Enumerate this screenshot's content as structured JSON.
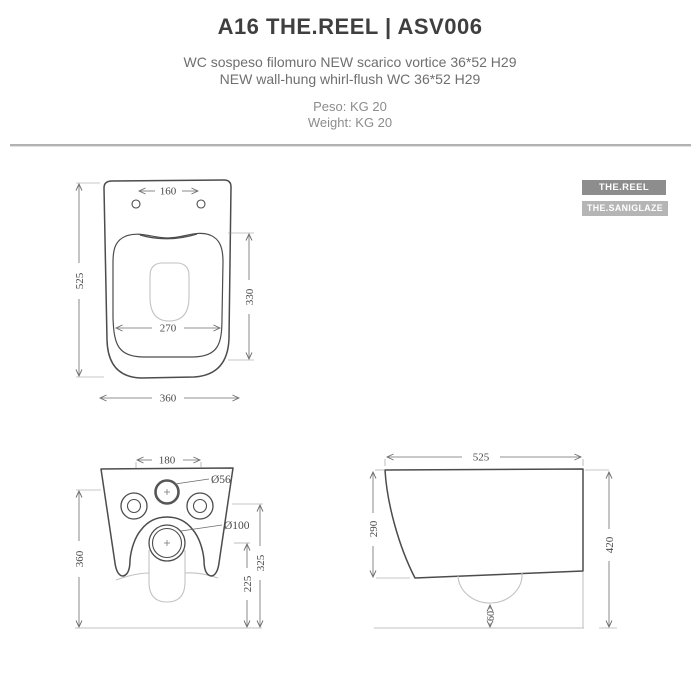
{
  "header": {
    "title": "A16 THE.REEL | ASV006",
    "subtitle_it": "WC sospeso filomuro NEW scarico vortice 36*52  H29",
    "subtitle_en": "NEW wall-hung whirl-flush WC 36*52  H29",
    "peso": "Peso: KG 20",
    "weight": "Weight: KG 20"
  },
  "badges": [
    {
      "label": "THE.REEL",
      "bg": "#8d8d8d"
    },
    {
      "label": "THE.SANIGLAZE",
      "bg": "#b5b5b5"
    }
  ],
  "colors": {
    "title_text": "#3f3f3f",
    "subtitle_text": "#6f6f6f",
    "divider": "#b2b2b2",
    "drawing_line": "#4c4c4c",
    "hidden_line": "#c2c2c2",
    "dimension_text": "#4a4a4a"
  },
  "drawings": {
    "top_view": {
      "dims": {
        "hole_spacing": "160",
        "depth": "525",
        "bowl_length": "330",
        "bowl_width": "270",
        "width": "360"
      }
    },
    "back_view": {
      "dims": {
        "fixing_spacing": "180",
        "inlet_diameter": "Ø56",
        "outlet_diameter": "Ø100",
        "height": "360",
        "outlet_center_height": "225",
        "fixing_height": "325"
      }
    },
    "side_view": {
      "dims": {
        "depth": "525",
        "front_height": "290",
        "total_height": "420",
        "outlet_offset": "60"
      }
    }
  }
}
